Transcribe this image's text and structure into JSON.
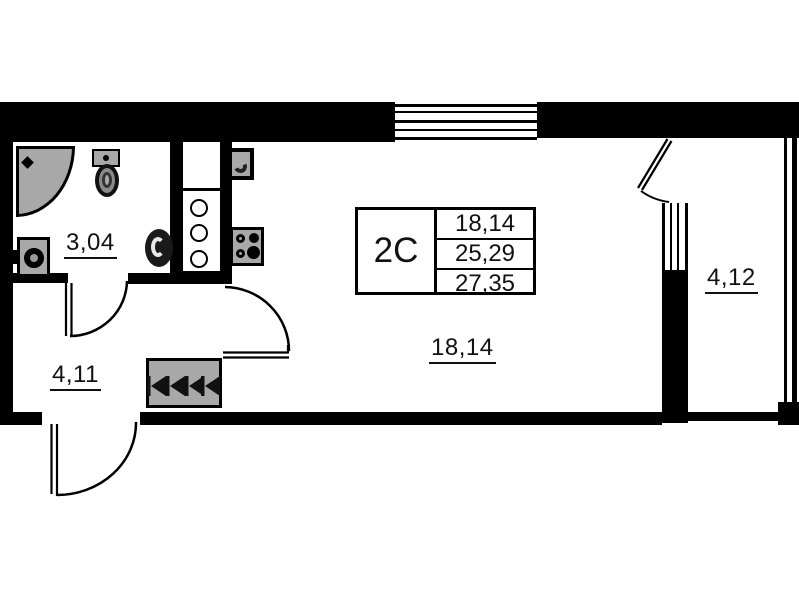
{
  "plan": {
    "unit": {
      "label": "2С"
    },
    "info_table": {
      "rows": [
        {
          "value": "18,14"
        },
        {
          "value": "25,29"
        },
        {
          "value": "27,35"
        }
      ]
    },
    "rooms": [
      {
        "name": "bathroom",
        "area": "3,04"
      },
      {
        "name": "hallway",
        "area": "4,11"
      },
      {
        "name": "living-room",
        "area": "18,14"
      },
      {
        "name": "balcony",
        "area": "4,12"
      }
    ],
    "fixtures": [
      "corner-shower",
      "toilet",
      "washbasin",
      "round-sink",
      "kitchen-cabinet",
      "stove",
      "sink-unit",
      "radiator",
      "window",
      "balcony-window",
      "entrance-door",
      "bathroom-door",
      "living-room-door",
      "balcony-door"
    ],
    "colors": {
      "wall": "#000000",
      "fixture": "#a8a8a8",
      "background": "#ffffff",
      "text": "#111111"
    }
  }
}
